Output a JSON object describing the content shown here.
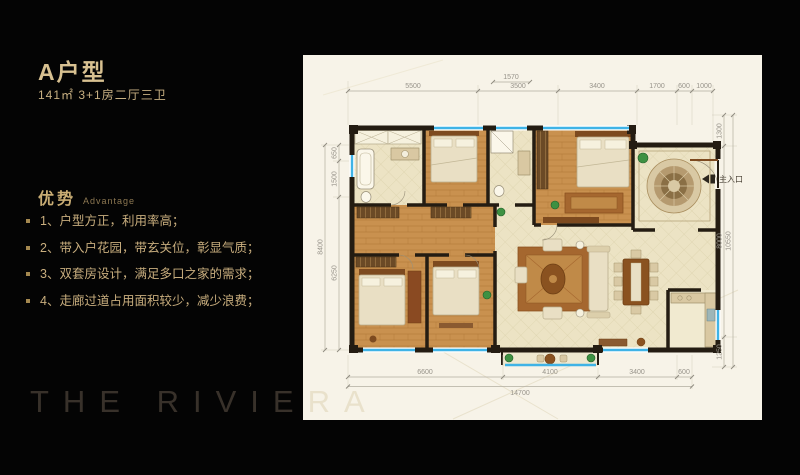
{
  "slide": {
    "title": "A户型",
    "subtitle": "141㎡ 3+1房二厅三卫"
  },
  "advantage": {
    "heading": "优势",
    "heading_en": "Advantage",
    "items": [
      "1、户型方正，利用率高；",
      "2、带入户花园，带玄关位，彰显气质；",
      "3、双套房设计，满足多口之家的需求；",
      "4、走廊过道占用面积较少，减少浪费；"
    ]
  },
  "watermark": "THE RIVIERA",
  "floorplan": {
    "entrance": "主入口",
    "dims": {
      "top": [
        "5500",
        "3500",
        "3400",
        "1700",
        "600",
        "1000"
      ],
      "top_sub": "1570",
      "bottom": [
        "6600",
        "4100",
        "3400",
        "600"
      ],
      "bottom_total": "14700",
      "right": [
        "1300",
        "8000",
        "1250"
      ],
      "right_total": "10550",
      "left": [
        "650",
        "1500",
        "6250"
      ],
      "left_total": "8400"
    },
    "colors": {
      "paper": "#f7f3e8",
      "wall": "#241c12",
      "wood_floor": "#c9914f",
      "tile_floor": "#ece3c4",
      "window_blue": "#3fb3e6",
      "rug_brown": "#a5672f",
      "gold_text": "#c9ae7e",
      "plant_green": "#3e9142"
    }
  }
}
